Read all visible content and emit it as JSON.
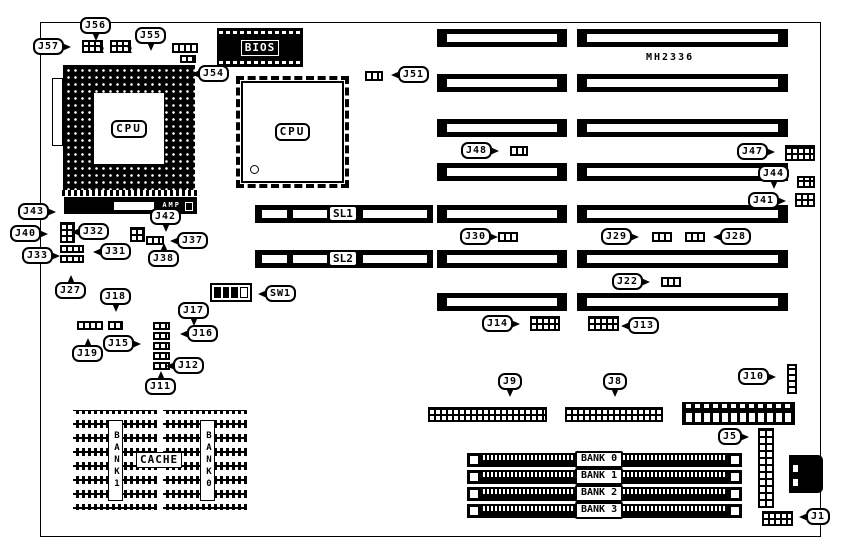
{
  "diagram": {
    "board_model": "MH2336",
    "bios": {
      "label": "BIOS"
    },
    "cpu_socket": {
      "label": "CPU"
    },
    "cpu_qfp": {
      "label": "CPU"
    },
    "amp_connector": {
      "label": "AMP"
    },
    "cache": {
      "label": "CACHE",
      "bank_left": "BANK1",
      "bank_right": "BANK0"
    },
    "pin2_markers": [
      {
        "text": "2",
        "x": 99,
        "y": 46
      },
      {
        "text": "2",
        "x": 127,
        "y": 46
      }
    ],
    "sw1": {
      "positions": [
        "on",
        "on",
        "on",
        "off"
      ]
    },
    "expansion_slots": [
      {
        "x": 437,
        "y": 29,
        "w": 130
      },
      {
        "x": 577,
        "y": 29,
        "w": 211
      },
      {
        "x": 437,
        "y": 74,
        "w": 130
      },
      {
        "x": 577,
        "y": 74,
        "w": 211
      },
      {
        "x": 437,
        "y": 119,
        "w": 130
      },
      {
        "x": 577,
        "y": 119,
        "w": 211
      },
      {
        "x": 437,
        "y": 163,
        "w": 130
      },
      {
        "x": 577,
        "y": 163,
        "w": 211
      },
      {
        "x": 437,
        "y": 205,
        "w": 130
      },
      {
        "x": 577,
        "y": 205,
        "w": 211
      },
      {
        "x": 437,
        "y": 250,
        "w": 130
      },
      {
        "x": 577,
        "y": 250,
        "w": 211
      },
      {
        "x": 437,
        "y": 293,
        "w": 130
      },
      {
        "x": 577,
        "y": 293,
        "w": 211
      }
    ],
    "local_bus_slots": [
      {
        "label": "SL1",
        "x": 255,
        "y": 205,
        "w": 178
      },
      {
        "label": "SL2",
        "x": 255,
        "y": 250,
        "w": 178
      }
    ],
    "simm_banks": [
      {
        "label": "BANK 0",
        "x": 467,
        "y": 453
      },
      {
        "label": "BANK 1",
        "x": 467,
        "y": 470
      },
      {
        "label": "BANK 2",
        "x": 467,
        "y": 487
      },
      {
        "label": "BANK 3",
        "x": 467,
        "y": 504
      }
    ],
    "jumpers": [
      {
        "x": 82,
        "y": 40,
        "w": 21,
        "h": 13,
        "type": "grid2"
      },
      {
        "x": 110,
        "y": 40,
        "w": 21,
        "h": 13,
        "type": "grid2"
      },
      {
        "x": 172,
        "y": 43,
        "w": 26,
        "h": 10,
        "type": "strip"
      },
      {
        "x": 180,
        "y": 55,
        "w": 16,
        "h": 8,
        "type": "strip"
      },
      {
        "x": 365,
        "y": 71,
        "w": 18,
        "h": 10,
        "type": "strip"
      },
      {
        "x": 510,
        "y": 146,
        "w": 18,
        "h": 10,
        "type": "strip"
      },
      {
        "x": 785,
        "y": 145,
        "w": 30,
        "h": 16,
        "type": "grid2"
      },
      {
        "x": 797,
        "y": 176,
        "w": 18,
        "h": 12,
        "type": "grid2"
      },
      {
        "x": 795,
        "y": 193,
        "w": 20,
        "h": 14,
        "type": "grid2"
      },
      {
        "x": 60,
        "y": 222,
        "w": 15,
        "h": 21,
        "type": "grid2"
      },
      {
        "x": 60,
        "y": 245,
        "w": 24,
        "h": 8,
        "type": "strip"
      },
      {
        "x": 60,
        "y": 255,
        "w": 24,
        "h": 8,
        "type": "strip"
      },
      {
        "x": 130,
        "y": 227,
        "w": 15,
        "h": 15,
        "type": "grid2"
      },
      {
        "x": 146,
        "y": 236,
        "w": 18,
        "h": 9,
        "type": "strip"
      },
      {
        "x": 77,
        "y": 321,
        "w": 26,
        "h": 9,
        "type": "strip"
      },
      {
        "x": 108,
        "y": 321,
        "w": 15,
        "h": 9,
        "type": "strip"
      },
      {
        "x": 153,
        "y": 322,
        "w": 17,
        "h": 8,
        "type": "strip"
      },
      {
        "x": 153,
        "y": 332,
        "w": 17,
        "h": 8,
        "type": "strip"
      },
      {
        "x": 153,
        "y": 342,
        "w": 17,
        "h": 8,
        "type": "strip"
      },
      {
        "x": 153,
        "y": 352,
        "w": 17,
        "h": 8,
        "type": "strip"
      },
      {
        "x": 153,
        "y": 362,
        "w": 17,
        "h": 8,
        "type": "strip"
      },
      {
        "x": 498,
        "y": 232,
        "w": 20,
        "h": 10,
        "type": "strip"
      },
      {
        "x": 652,
        "y": 232,
        "w": 20,
        "h": 10,
        "type": "strip"
      },
      {
        "x": 685,
        "y": 232,
        "w": 20,
        "h": 10,
        "type": "strip"
      },
      {
        "x": 661,
        "y": 277,
        "w": 20,
        "h": 10,
        "type": "strip"
      },
      {
        "x": 530,
        "y": 316,
        "w": 30,
        "h": 15,
        "type": "grid2"
      },
      {
        "x": 588,
        "y": 316,
        "w": 31,
        "h": 15,
        "type": "grid2"
      },
      {
        "x": 428,
        "y": 407,
        "w": 119,
        "h": 15,
        "type": "grid2"
      },
      {
        "x": 565,
        "y": 407,
        "w": 98,
        "h": 15,
        "type": "grid2"
      },
      {
        "x": 787,
        "y": 364,
        "w": 10,
        "h": 30,
        "type": "vstrip"
      },
      {
        "x": 758,
        "y": 428,
        "w": 16,
        "h": 80,
        "type": "vgrid"
      },
      {
        "x": 762,
        "y": 511,
        "w": 31,
        "h": 15,
        "type": "grid2"
      }
    ],
    "callouts": [
      {
        "id": "J56",
        "x": 80,
        "y": 17,
        "tail": "down"
      },
      {
        "id": "J57",
        "x": 33,
        "y": 38,
        "tail": "right"
      },
      {
        "id": "J55",
        "x": 135,
        "y": 27,
        "tail": "down"
      },
      {
        "id": "J54",
        "x": 198,
        "y": 65,
        "tail": "left"
      },
      {
        "id": "J51",
        "x": 398,
        "y": 66,
        "tail": "left"
      },
      {
        "id": "J48",
        "x": 461,
        "y": 142,
        "tail": "right"
      },
      {
        "id": "J47",
        "x": 737,
        "y": 143,
        "tail": "right"
      },
      {
        "id": "J44",
        "x": 758,
        "y": 165,
        "tail": "down"
      },
      {
        "id": "J41",
        "x": 748,
        "y": 192,
        "tail": "right"
      },
      {
        "id": "J43",
        "x": 18,
        "y": 203,
        "tail": "right"
      },
      {
        "id": "J40",
        "x": 10,
        "y": 225,
        "tail": "right"
      },
      {
        "id": "J33",
        "x": 22,
        "y": 247,
        "tail": "right"
      },
      {
        "id": "J32",
        "x": 78,
        "y": 223,
        "tail": "left"
      },
      {
        "id": "J31",
        "x": 100,
        "y": 243,
        "tail": "left"
      },
      {
        "id": "J27",
        "x": 55,
        "y": 282,
        "tail": "up"
      },
      {
        "id": "J42",
        "x": 150,
        "y": 208,
        "tail": "down"
      },
      {
        "id": "J37",
        "x": 177,
        "y": 232,
        "tail": "left"
      },
      {
        "id": "J38",
        "x": 148,
        "y": 250,
        "tail": "up"
      },
      {
        "id": "J18",
        "x": 100,
        "y": 288,
        "tail": "down"
      },
      {
        "id": "J19",
        "x": 72,
        "y": 345,
        "tail": "up"
      },
      {
        "id": "J15",
        "x": 103,
        "y": 335,
        "tail": "right"
      },
      {
        "id": "J17",
        "x": 178,
        "y": 302,
        "tail": "down"
      },
      {
        "id": "J16",
        "x": 187,
        "y": 325,
        "tail": "left"
      },
      {
        "id": "J12",
        "x": 173,
        "y": 357,
        "tail": "left"
      },
      {
        "id": "J11",
        "x": 145,
        "y": 378,
        "tail": "up"
      },
      {
        "id": "SW1",
        "x": 265,
        "y": 285,
        "tail": "left"
      },
      {
        "id": "J30",
        "x": 460,
        "y": 228,
        "tail": "right"
      },
      {
        "id": "J29",
        "x": 601,
        "y": 228,
        "tail": "right"
      },
      {
        "id": "J28",
        "x": 720,
        "y": 228,
        "tail": "left"
      },
      {
        "id": "J22",
        "x": 612,
        "y": 273,
        "tail": "right"
      },
      {
        "id": "J14",
        "x": 482,
        "y": 315,
        "tail": "right"
      },
      {
        "id": "J13",
        "x": 628,
        "y": 317,
        "tail": "left"
      },
      {
        "id": "J9",
        "x": 498,
        "y": 373,
        "tail": "down"
      },
      {
        "id": "J8",
        "x": 603,
        "y": 373,
        "tail": "down"
      },
      {
        "id": "J10",
        "x": 738,
        "y": 368,
        "tail": "right"
      },
      {
        "id": "J5",
        "x": 718,
        "y": 428,
        "tail": "right"
      },
      {
        "id": "J1",
        "x": 806,
        "y": 508,
        "tail": "left"
      }
    ]
  }
}
